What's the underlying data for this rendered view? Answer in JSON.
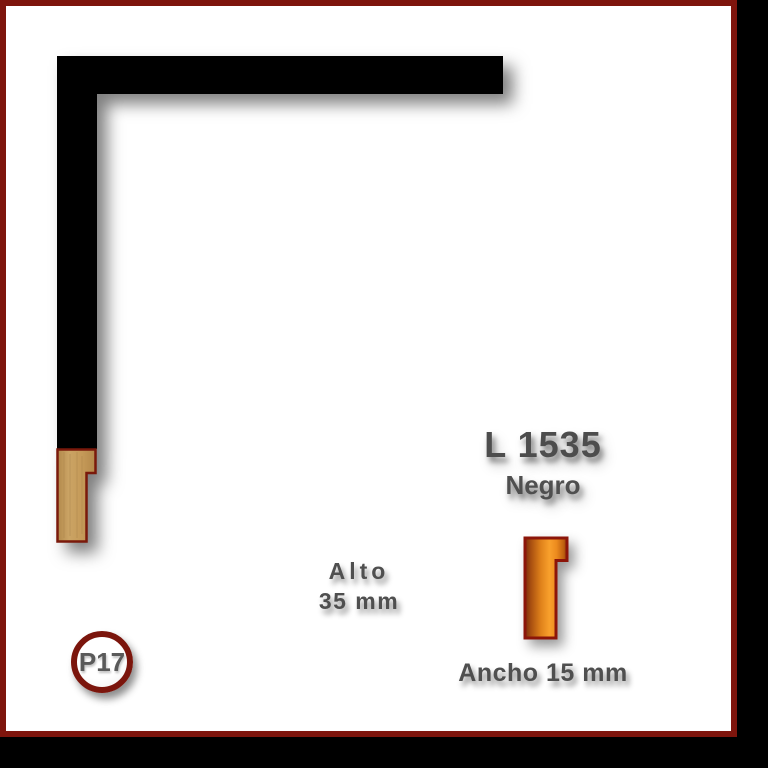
{
  "product": {
    "code": "L 1535",
    "finish": "Negro",
    "badge": "P17"
  },
  "dimensions": {
    "height_label": "Alto",
    "height_value": "35 mm",
    "width_label": "Ancho 15 mm"
  },
  "colors": {
    "card_border": "#7e150d",
    "card_background": "#ffffff",
    "letterbox_background": "#000000",
    "frame_sample": "#000000",
    "wood_endgrain": "#c79c5e",
    "profile_orange_bright": "#f9a02c",
    "profile_orange_dark": "#7b2d0b",
    "profile_outline": "#8c1509",
    "text": "#4f4f4f",
    "badge_ring": "#7b150c"
  }
}
